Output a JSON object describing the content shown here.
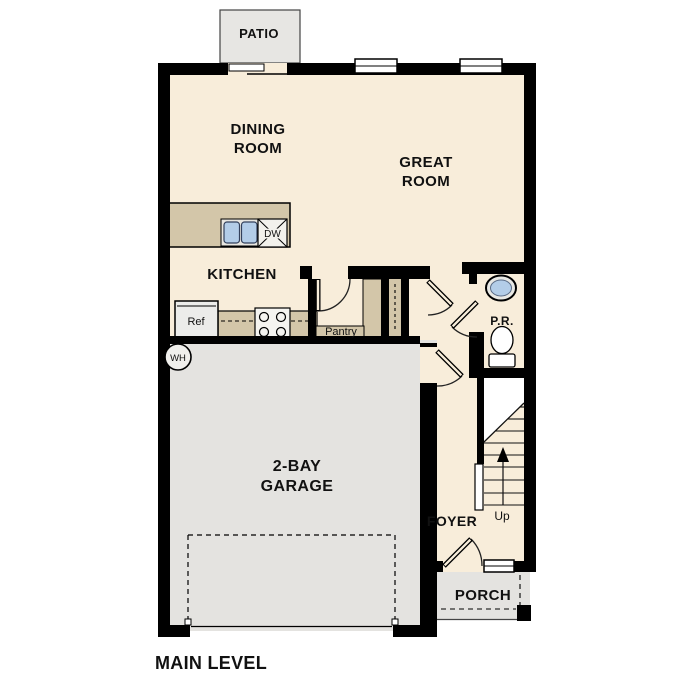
{
  "plan": {
    "level_title": "MAIN LEVEL",
    "rooms": {
      "patio": "PATIO",
      "dining": {
        "line1": "DINING",
        "line2": "ROOM"
      },
      "great": {
        "line1": "GREAT",
        "line2": "ROOM"
      },
      "kitchen": "KITCHEN",
      "garage": {
        "line1": "2-BAY",
        "line2": "GARAGE"
      },
      "foyer": "FOYER",
      "porch": "PORCH",
      "powder_room": "P.R.",
      "pantry": "Pantry"
    },
    "fixtures": {
      "refrigerator": "Ref",
      "dishwasher": "DW",
      "water_heater": "WH",
      "stairs_up": "Up"
    },
    "colors": {
      "wall": "#000000",
      "floor_cream": "#f8edda",
      "garage_gray": "#e4e3e0",
      "casework_tan": "#d3c6a9",
      "sink_blue": "#b3cde8",
      "white": "#ffffff"
    }
  }
}
